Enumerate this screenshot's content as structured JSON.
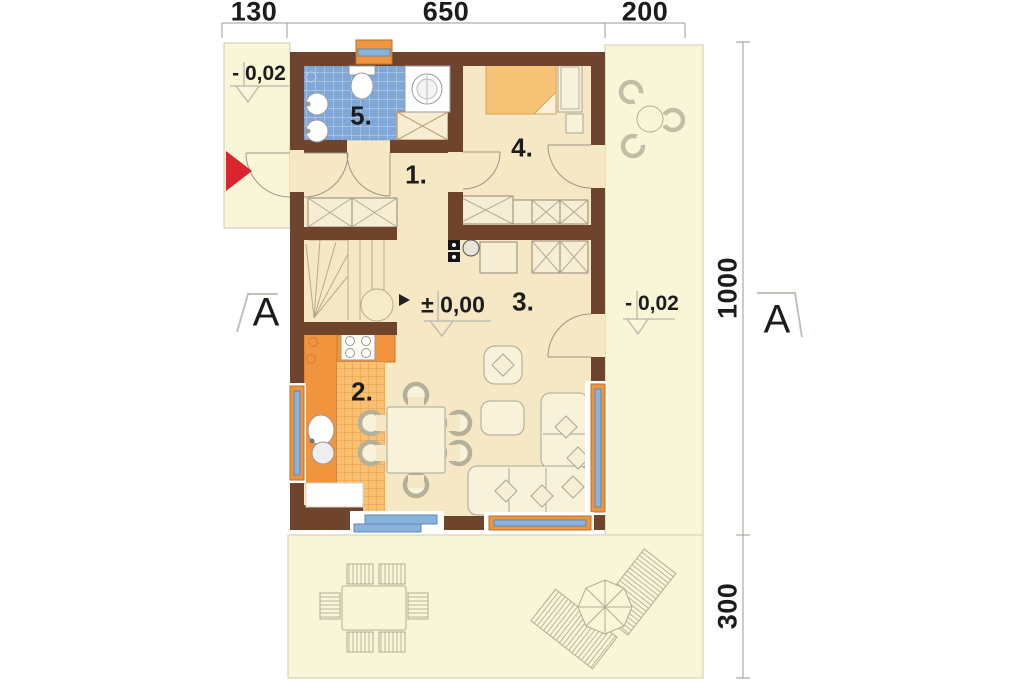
{
  "plan": {
    "dimensions_top": [
      {
        "label": "130"
      },
      {
        "label": "650"
      },
      {
        "label": "200"
      }
    ],
    "dimensions_right": [
      {
        "label": "1000"
      },
      {
        "label": "300"
      }
    ],
    "levels": {
      "porch": "- 0,02",
      "interior": "± 0,00",
      "side_yard": "- 0,02"
    },
    "rooms": [
      {
        "number": "1."
      },
      {
        "number": "2."
      },
      {
        "number": "3."
      },
      {
        "number": "4."
      },
      {
        "number": "5."
      }
    ],
    "section_marks": {
      "left": "A",
      "right": "A"
    },
    "entrance_marker": "right-arrow",
    "colors": {
      "wall": "#6e452c",
      "exterior_ground": "#f9f6d8",
      "interior_floor": "#f6e8c4",
      "bathroom_tile": "#7fa8d9",
      "kitchen_accent": "#f0943d",
      "window_glass": "#8ab3dc",
      "entrance_arrow": "#d9252b"
    }
  }
}
